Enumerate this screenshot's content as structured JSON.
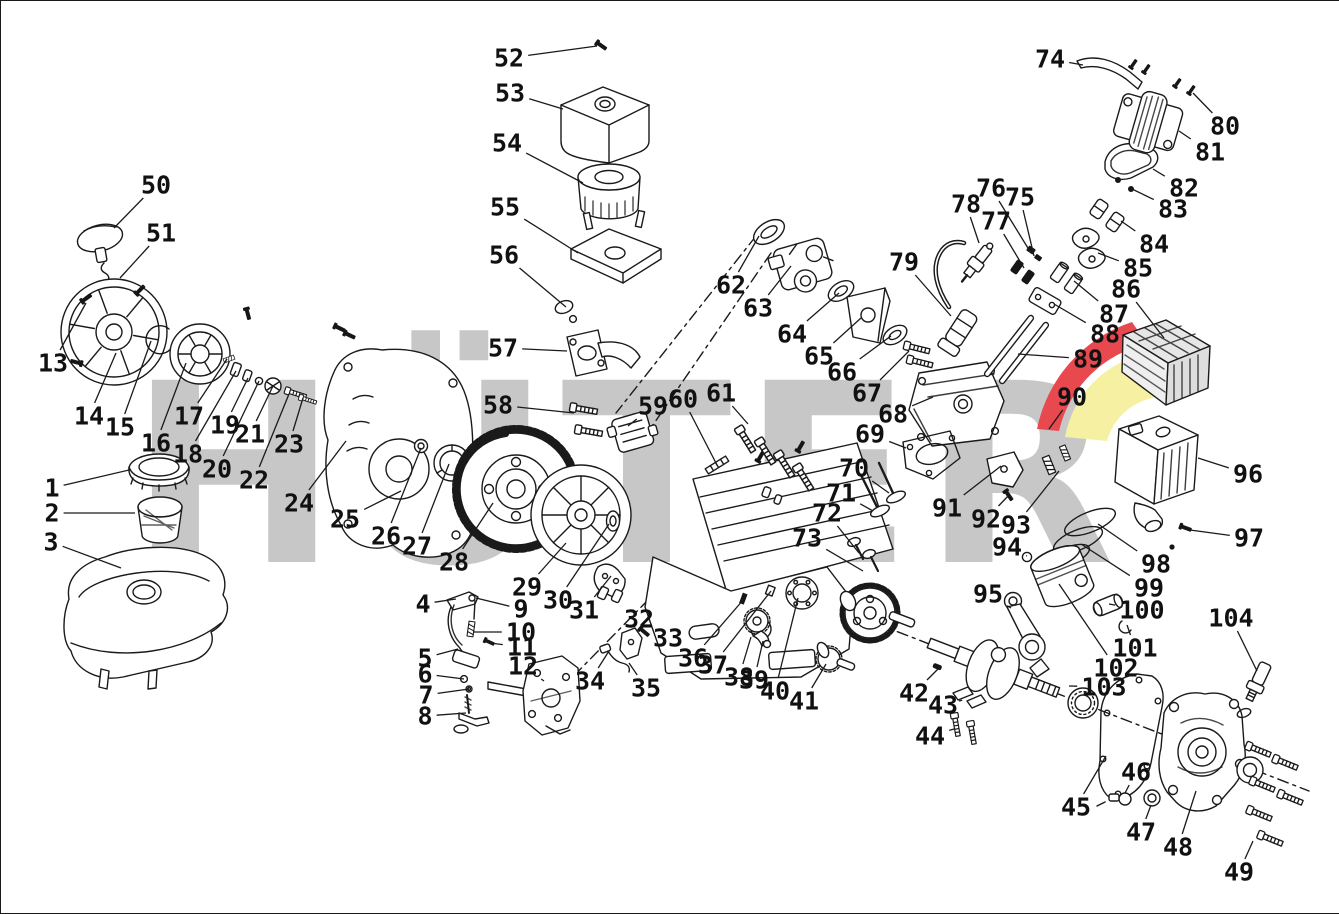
{
  "meta": {
    "type": "exploded-parts-diagram",
    "subject": "small gasoline engine"
  },
  "canvas": {
    "width": 1339,
    "height": 912,
    "background": "#ffffff",
    "frame_color": "#1a1a1a",
    "line_color": "#1a1a1a",
    "label_color": "#111111"
  },
  "watermark": {
    "text": "HÜTER",
    "letters_color": "#c7c7c7",
    "accent_red": "#e8494f",
    "accent_yellow": "#f6f0a2"
  },
  "labels": [
    [
      1,
      51,
      487,
      128,
      469
    ],
    [
      2,
      51,
      512,
      134,
      512
    ],
    [
      3,
      50,
      541,
      120,
      567
    ],
    [
      4,
      422,
      603,
      455,
      598
    ],
    [
      5,
      424,
      657,
      457,
      648
    ],
    [
      6,
      424,
      673,
      463,
      678
    ],
    [
      7,
      425,
      694,
      468,
      688
    ],
    [
      8,
      424,
      715,
      465,
      712
    ],
    [
      9,
      520,
      608,
      475,
      597
    ],
    [
      10,
      520,
      631,
      472,
      631
    ],
    [
      11,
      521,
      646,
      489,
      642
    ],
    [
      12,
      522,
      665,
      543,
      680
    ],
    [
      13,
      52,
      362,
      85,
      302
    ],
    [
      14,
      88,
      415,
      115,
      352
    ],
    [
      15,
      119,
      426,
      150,
      340
    ],
    [
      16,
      155,
      442,
      185,
      362
    ],
    [
      17,
      188,
      415,
      226,
      358
    ],
    [
      18,
      187,
      453,
      235,
      370
    ],
    [
      19,
      224,
      424,
      247,
      377
    ],
    [
      20,
      216,
      468,
      258,
      380
    ],
    [
      21,
      249,
      433,
      272,
      385
    ],
    [
      22,
      253,
      479,
      288,
      393
    ],
    [
      23,
      288,
      443,
      302,
      397
    ],
    [
      24,
      298,
      502,
      345,
      440
    ],
    [
      25,
      344,
      518,
      400,
      490
    ],
    [
      26,
      385,
      535,
      420,
      447
    ],
    [
      27,
      416,
      545,
      448,
      463
    ],
    [
      28,
      453,
      561,
      492,
      502
    ],
    [
      29,
      526,
      586,
      565,
      542
    ],
    [
      30,
      557,
      599,
      608,
      523
    ],
    [
      31,
      583,
      609,
      610,
      575
    ],
    [
      32,
      638,
      618,
      644,
      632
    ],
    [
      33,
      667,
      637,
      657,
      624
    ],
    [
      34,
      589,
      680,
      608,
      650
    ],
    [
      35,
      645,
      687,
      628,
      662
    ],
    [
      36,
      692,
      657,
      743,
      598
    ],
    [
      37,
      712,
      664,
      770,
      590
    ],
    [
      38,
      738,
      676,
      750,
      636
    ],
    [
      39,
      753,
      679,
      762,
      640
    ],
    [
      40,
      774,
      690,
      797,
      597
    ],
    [
      41,
      803,
      700,
      825,
      663
    ],
    [
      42,
      913,
      692,
      937,
      668
    ],
    [
      43,
      942,
      704,
      958,
      700
    ],
    [
      44,
      929,
      735,
      953,
      728
    ],
    [
      45,
      1075,
      806,
      1105,
      755
    ],
    [
      46,
      1135,
      771,
      1124,
      792
    ],
    [
      47,
      1140,
      831,
      1150,
      804
    ],
    [
      48,
      1177,
      846,
      1195,
      790
    ],
    [
      49,
      1238,
      871,
      1252,
      840
    ],
    [
      50,
      155,
      184,
      113,
      227
    ],
    [
      51,
      160,
      232,
      119,
      277
    ],
    [
      52,
      508,
      57,
      596,
      45
    ],
    [
      53,
      509,
      92,
      562,
      108
    ],
    [
      54,
      506,
      142,
      582,
      182
    ],
    [
      55,
      504,
      206,
      577,
      252
    ],
    [
      56,
      503,
      254,
      565,
      306
    ],
    [
      57,
      502,
      347,
      566,
      350
    ],
    [
      58,
      497,
      404,
      573,
      412
    ],
    [
      59,
      652,
      405,
      627,
      425
    ],
    [
      60,
      682,
      398,
      716,
      464
    ],
    [
      61,
      720,
      392,
      747,
      423
    ],
    [
      62,
      730,
      284,
      758,
      235
    ],
    [
      63,
      757,
      307,
      790,
      265
    ],
    [
      64,
      791,
      333,
      838,
      292
    ],
    [
      65,
      818,
      355,
      860,
      317
    ],
    [
      66,
      841,
      371,
      890,
      335
    ],
    [
      67,
      866,
      392,
      908,
      350
    ],
    [
      68,
      892,
      413,
      932,
      396
    ],
    [
      69,
      869,
      433,
      905,
      447
    ],
    [
      70,
      853,
      467,
      888,
      492
    ],
    [
      71,
      840,
      492,
      872,
      510
    ],
    [
      72,
      826,
      512,
      858,
      552
    ],
    [
      73,
      806,
      537,
      862,
      570
    ],
    [
      74,
      1049,
      58,
      1082,
      64
    ],
    [
      75,
      1019,
      196,
      1033,
      255
    ],
    [
      76,
      990,
      187,
      1030,
      252
    ],
    [
      77,
      995,
      220,
      1023,
      267
    ],
    [
      78,
      965,
      203,
      978,
      242
    ],
    [
      79,
      903,
      261,
      950,
      315
    ],
    [
      80,
      1224,
      125,
      1192,
      92
    ],
    [
      81,
      1209,
      151,
      1178,
      130
    ],
    [
      82,
      1183,
      187,
      1152,
      168
    ],
    [
      83,
      1172,
      208,
      1131,
      188
    ],
    [
      84,
      1153,
      243,
      1120,
      220
    ],
    [
      85,
      1137,
      267,
      1097,
      252
    ],
    [
      86,
      1125,
      288,
      1163,
      337
    ],
    [
      87,
      1113,
      313,
      1073,
      280
    ],
    [
      88,
      1104,
      333,
      1053,
      303
    ],
    [
      89,
      1087,
      358,
      1017,
      353
    ],
    [
      90,
      1071,
      396,
      1048,
      428
    ],
    [
      91,
      946,
      507,
      1000,
      465
    ],
    [
      92,
      985,
      518,
      1008,
      494
    ],
    [
      93,
      1015,
      524,
      1058,
      470
    ],
    [
      94,
      1006,
      546,
      1026,
      555
    ],
    [
      95,
      987,
      593,
      1010,
      607
    ],
    [
      96,
      1247,
      473,
      1197,
      457
    ],
    [
      97,
      1248,
      537,
      1189,
      529
    ],
    [
      98,
      1155,
      563,
      1097,
      523
    ],
    [
      99,
      1148,
      587,
      1080,
      543
    ],
    [
      100,
      1141,
      609,
      1108,
      603
    ],
    [
      101,
      1134,
      647,
      1126,
      624
    ],
    [
      102,
      1115,
      667,
      1058,
      583
    ],
    [
      103,
      1103,
      686,
      1068,
      685
    ],
    [
      104,
      1230,
      617,
      1256,
      670
    ]
  ]
}
